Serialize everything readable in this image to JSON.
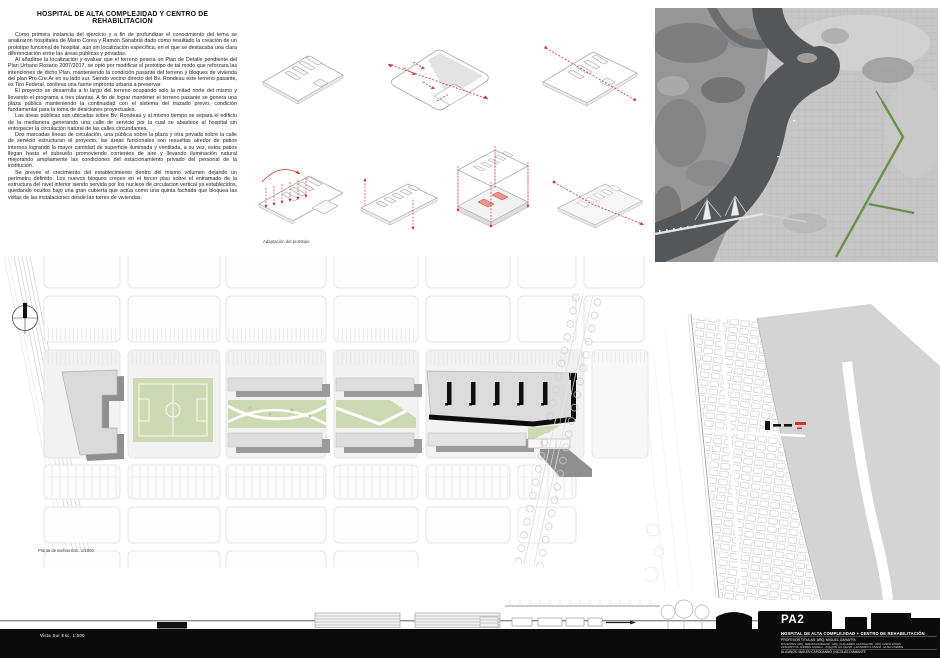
{
  "colors": {
    "accent_red": "#d0312d",
    "plan_green": "#ccd9b3",
    "boulevard_green": "#618c40",
    "footer_black": "#0b0b0b",
    "paper": "#ffffff"
  },
  "memoria": {
    "title": "HOSPITAL DE ALTA COMPLEJIDAD Y CENTRO DE REHABILITACIÓN",
    "paragraphs": [
      "Como primera instancia del ejercicio y a fin de profundizar el conocimiento del tema se analizaron hospitales de Mario Corea y Ramón Sanabria dado como resultado la creación de un prototipo funcional de hospital, aún sin localización específica, en el que se destacaba una clara diferenciación  entre las áreas públicas y privadas.",
      "Al añadirse la localización y evaluar que el terreno poseía un Plan de Detalle pendiente del Plan Urbano Rosario 2007/2017, se optó por modificar el prototipo de tal modo que reforzara las intenciones de dicho Plan, manteniendo la condición pasante del terreno y bloques de vivienda del plan Pro.Cre.Ar en su lado sur.  Siendo vecino directo del Bv. Rondeau este terreno pasante, ex Tiro Federal, conlleva una fuerte impronta urbana a preservar.",
      "El proyecto se desarrolla a lo largo del terreno ocupando solo la mitad norte del mismo y llevando el programa a tres plantas. A fin de lograr mantener el terreno pasante se genera una plaza pública manteniendo la continuidad con el sistema del trazado previo, condición fundamental para la toma de desiciones proyectuales.",
      "Las áreas públicas son ubicadas sobre Bv. Rondeau y al mismo tiempo se separa el edificio de la medianera generando una calle de servicio por la cual se abastece al hospital sin entorpecer la circulación natural de las calles circundantes.",
      "Dos marcadas líneas de circulación, una pública sobre la plaza y otra privada sobre la calle de servicio estructuran el proyecto, las áreas funcionales son resueltas alredor de patios internos logrando la mayor cantidad de superficie iluminada y ventilada, a su vez, estos patios llegan hasta el subsuelo promoviendo corrientes de aire y llevando iluminación natural mejorando ampliamente las condiciones del estacionamiento privado del personal de la institución.",
      "Se prevee el  crecimiento del establecimiento dentro del mismo volumen dejando un perímetro definido.  Los nuevos bloques crecen  en el tercer piso sobre  el entramado de la estructura del nivel inferior siendo servida por los nucleos de circulacion vertical ya establecidos, quedando ocultos bajo una gran cubierta que actúa como una quinta fachada que bloquea las vistas de las instalaciones  desde las torres de viviendas."
    ]
  },
  "prototype_diagrams": {
    "caption": "Adaptación del prototipo"
  },
  "site_plan": {
    "caption": "Planta de techos Esc. 1/1000"
  },
  "elevation": {
    "caption": "Vista Sur   Esc. 1:500"
  },
  "title_block": {
    "code": "PA2",
    "project": "HOSPITAL DE ALTA COMPLEJIDAD + CENTRO DE REHABILITACIÓN",
    "professor": "PROFESOR TITULAR: ARQ. MIGUEL GARAFFA",
    "staff_line1": "DOCENTES:  ARQ. SEBASTIAN BEGUE - ARQ. GUILLERMO CASTIGLIONI - ARQ. DARIO JONAS",
    "staff_line2": "ADSCRIPTOS: ANDRES CARELLI - JOAQUIN GIL CELSO - LEONARDO LOSADA - ELISA LISERRE",
    "students": "ALUMNOS: MAILEN CAPODANNO | NICOLAS DIAMANTE"
  }
}
